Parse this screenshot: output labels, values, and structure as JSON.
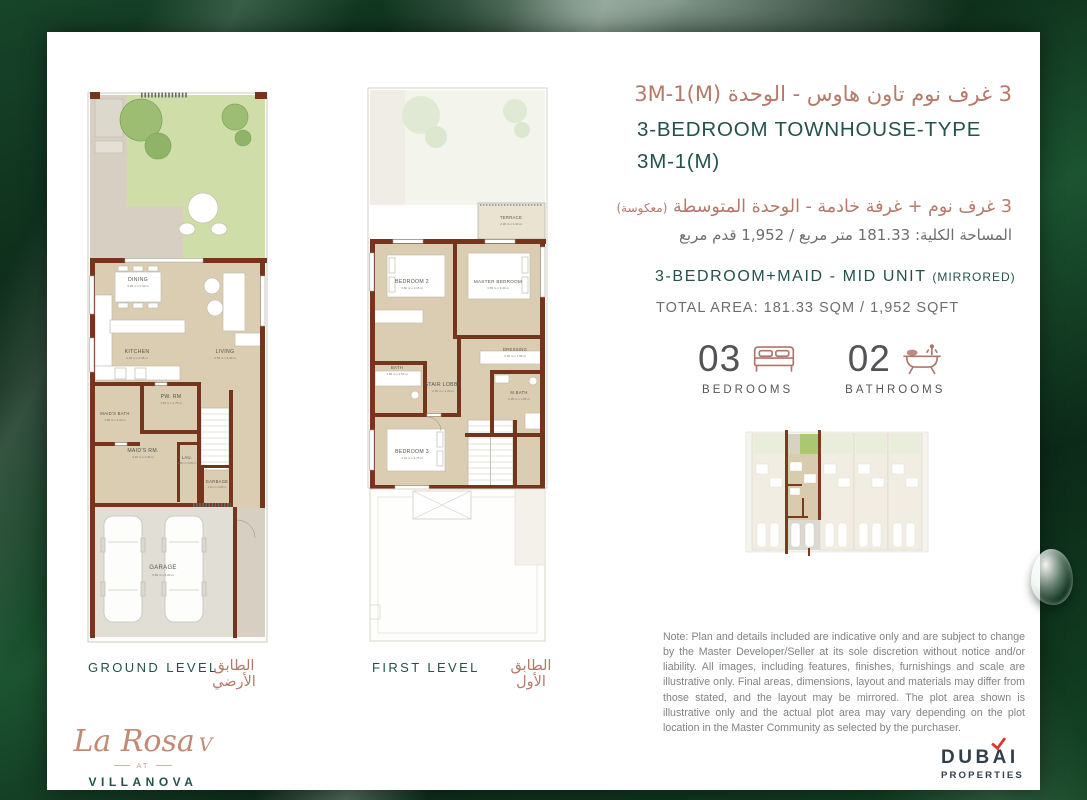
{
  "colors": {
    "accent_teal": "#24524a",
    "accent_rose": "#b5796a",
    "wall_brown": "#74351c",
    "text_gray": "#6d6e71",
    "brand_red": "#e2352b",
    "brand_navy": "#323e49",
    "background_green": "#0d2c1a"
  },
  "header": {
    "title_ar": "3 غرف نوم تاون هاوس - الوحدة 3M-1(M)",
    "title_en_line1": "3-BEDROOM TOWNHOUSE-TYPE",
    "title_en_line2": "3M-1(M)",
    "subtitle_ar": "3 غرف نوم + غرفة خادمة - الوحدة المتوسطة",
    "subtitle_ar_note": "(معكوسة)",
    "area_ar": "المساحة الكلية: 181.33 متر مربع / 1,952 قدم مربع",
    "subtitle_en": "3-BEDROOM+MAID - MID UNIT",
    "subtitle_en_note": "(MIRRORED)",
    "area_en": "TOTAL AREA: 181.33 SQM / 1,952 SQFT"
  },
  "stats": {
    "bedrooms": {
      "count": "03",
      "label": "BEDROOMS",
      "icon": "bed-icon"
    },
    "bathrooms": {
      "count": "02",
      "label": "BATHROOMS",
      "icon": "bathtub-icon"
    }
  },
  "plans": {
    "ground": {
      "label_en": "GROUND LEVEL",
      "label_ar": "الطابق الأرضي",
      "rooms": [
        {
          "name": "DINING",
          "dims": "3.25 m x 3.10 m"
        },
        {
          "name": "KITCHEN",
          "dims": "3.15 m x 2.45 m"
        },
        {
          "name": "LIVING",
          "dims": "3.55 m x 6.40 m"
        },
        {
          "name": "PW. RM",
          "dims": "1.45 m x 1.75 m"
        },
        {
          "name": "MAID'S BATH",
          "dims": "1.90 m x 2.10 m"
        },
        {
          "name": "MAID'S RM.",
          "dims": "3.15 m x 2.30 m"
        },
        {
          "name": "LAU.",
          "dims": "1.00 m x 0.80 m"
        },
        {
          "name": "GARBAGE",
          "dims": "1.10 m x 0.80 m"
        },
        {
          "name": "GARAGE",
          "dims": "5.60 m x 6.00 m"
        }
      ]
    },
    "first": {
      "label_en": "FIRST LEVEL",
      "label_ar": "الطابق الأول",
      "rooms": [
        {
          "name": "TERRACE",
          "dims": "2.30 m x 1.30 m"
        },
        {
          "name": "BEDROOM 2",
          "dims": "3.60 m x 3.15 m"
        },
        {
          "name": "MASTER BEDROOM",
          "dims": "3.55 m x 3.40 m"
        },
        {
          "name": "DRESSING",
          "dims": "2.35 m x 1.55 m"
        },
        {
          "name": "BATH",
          "dims": "1.95 m x 2.50 m"
        },
        {
          "name": "STAIR LOBBY",
          "dims": "2.30 m x 1.20 m"
        },
        {
          "name": "M.BATH",
          "dims": "2.35 m x 1.85 m"
        },
        {
          "name": "BEDROOM 3",
          "dims": "3.10 m x 3.75 m"
        }
      ]
    }
  },
  "note": "Note: Plan and details included are indicative only and are subject to change by the Master Developer/Seller at its sole discretion without notice and/or liability. All images, including features, finishes, furnishings and scale are illustrative only. Final areas, dimensions, layout and materials may differ from those stated, and the layout may be mirrored. The plot area shown is illustrative only and the actual plot area may vary depending on the plot location in the Master Community as selected by the purchaser.",
  "brand": {
    "project_script": "La Rosa",
    "project_suffix": "V",
    "project_at": "AT",
    "project_parent": "VILLANOVA",
    "developer_part1": "DUB",
    "developer_a": "A",
    "developer_part2": "I",
    "developer_sub": "PROPERTIES"
  }
}
